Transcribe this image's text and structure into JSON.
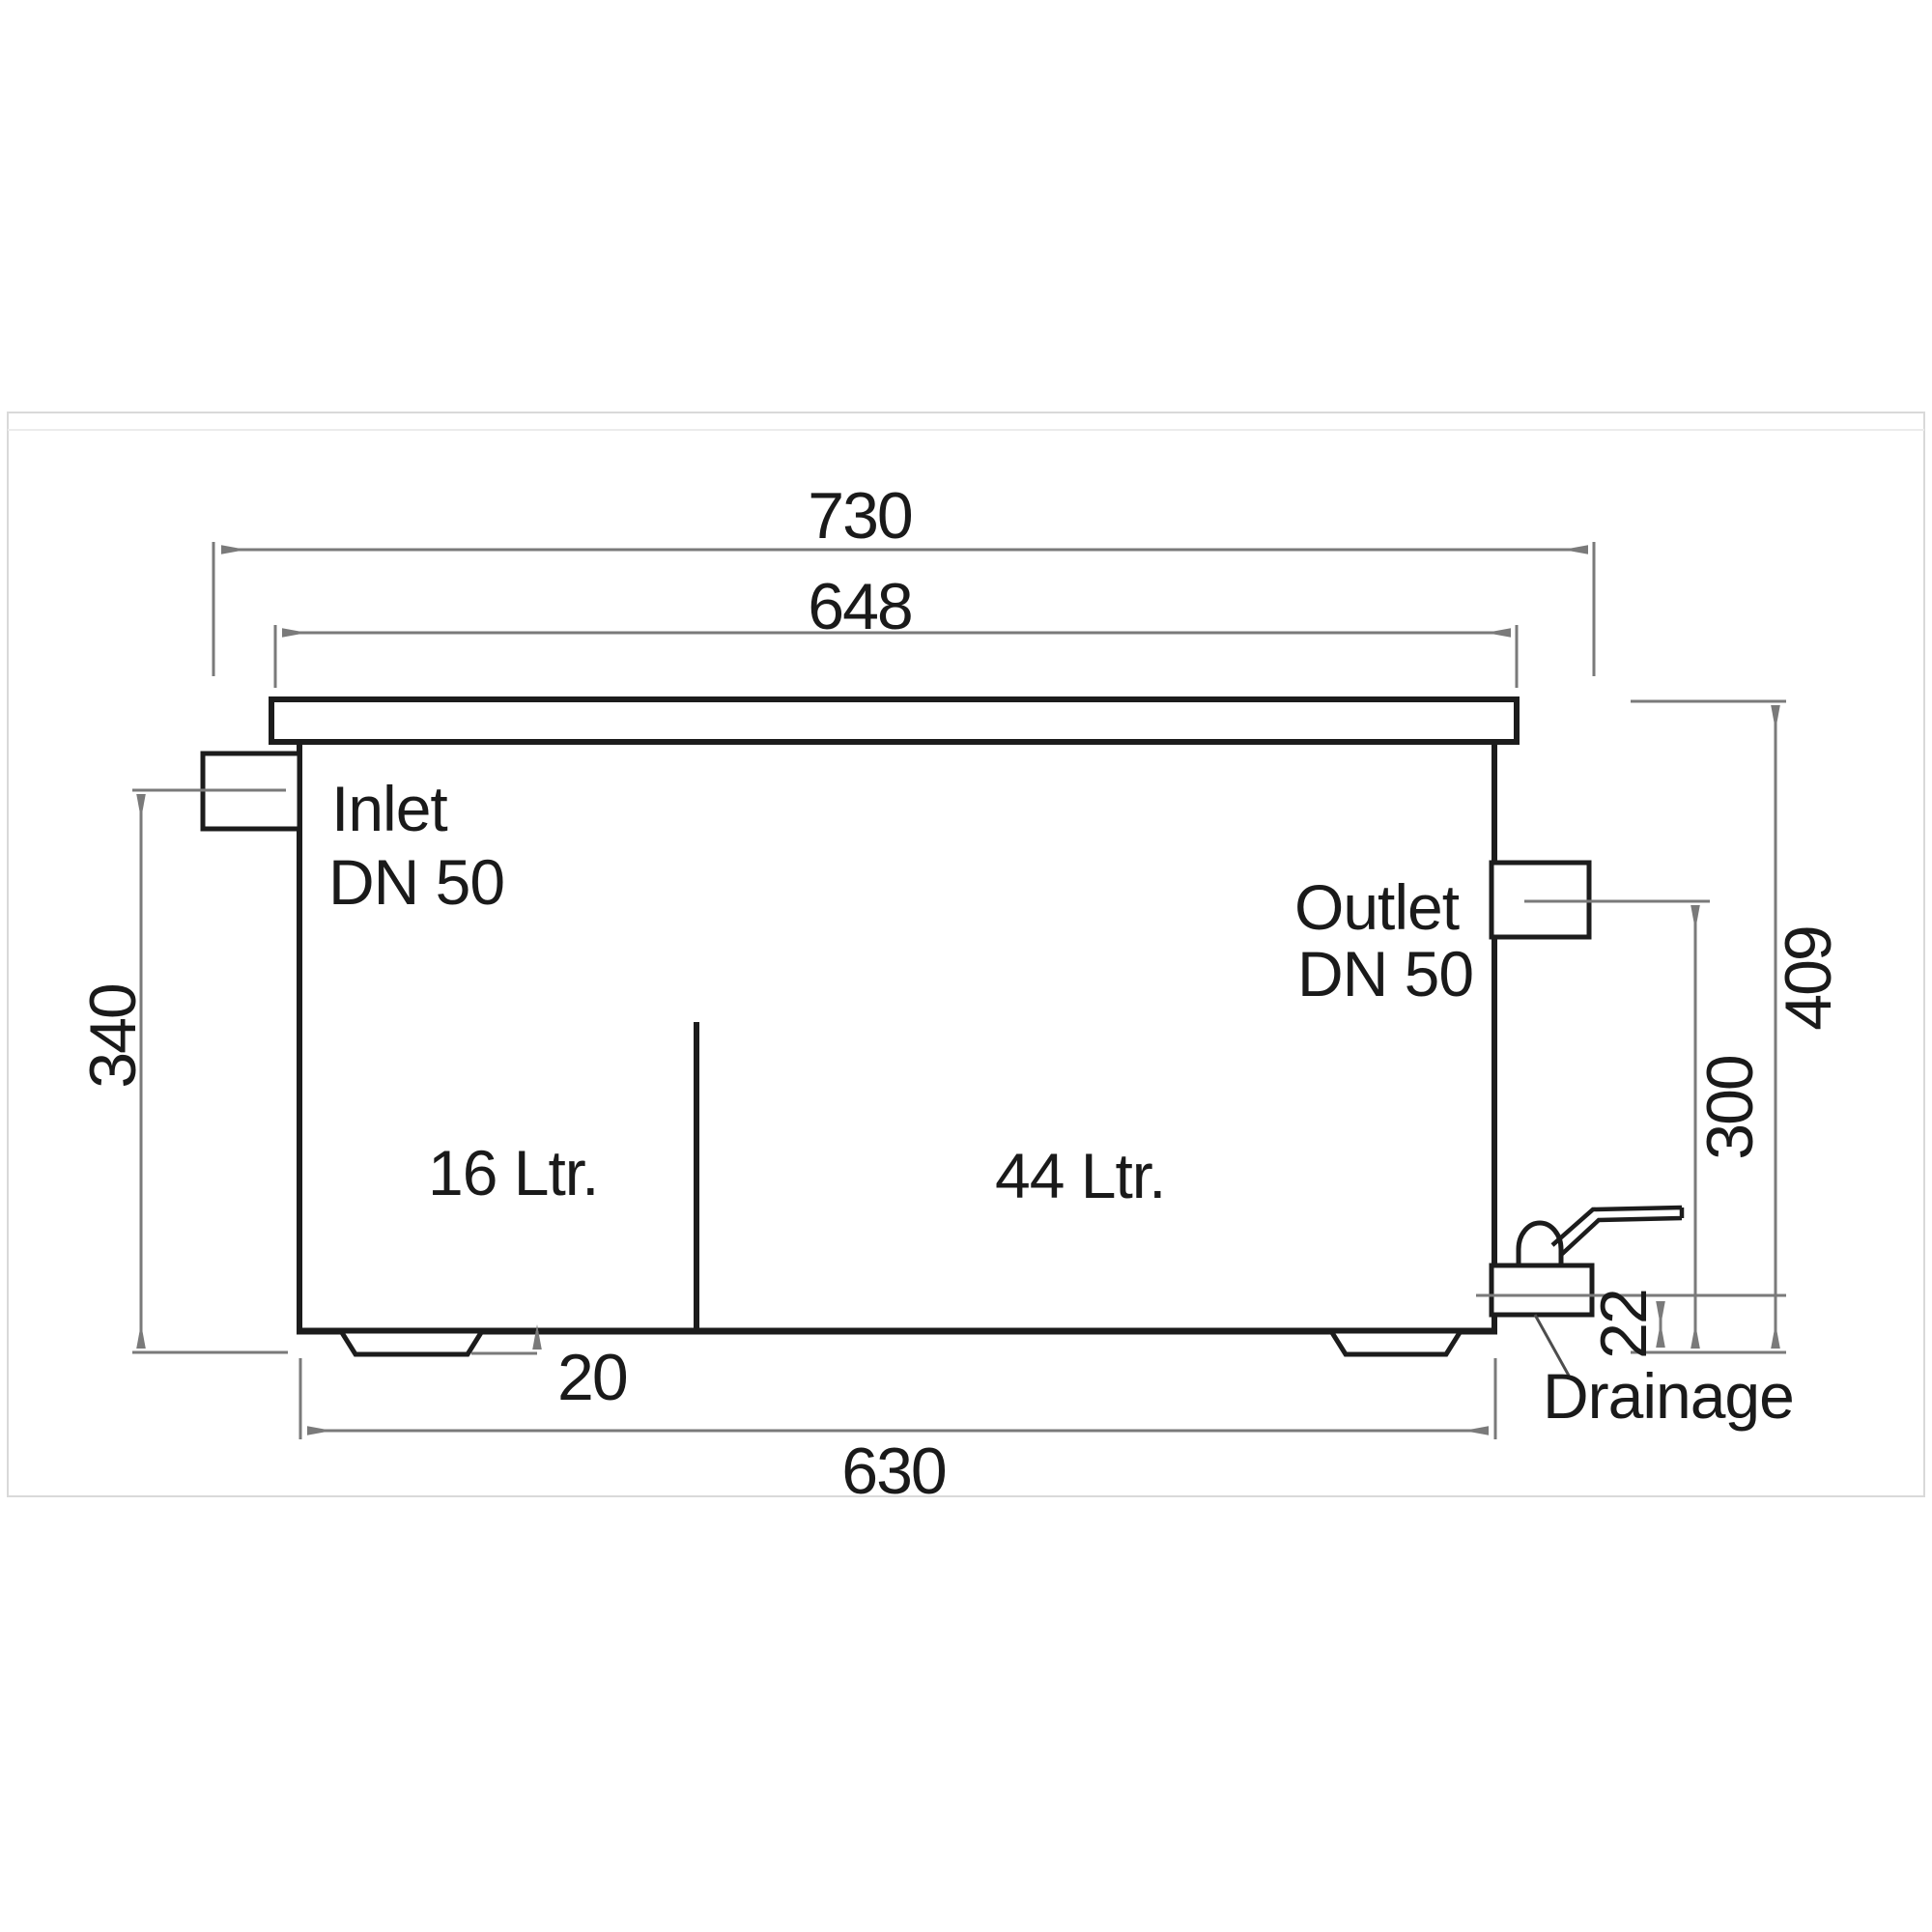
{
  "drawing": {
    "title_hint": "grease-separator side elevation technical drawing",
    "labels": {
      "inlet_line1": "Inlet",
      "inlet_line2": "DN 50",
      "outlet_line1": "Outlet",
      "outlet_line2": "DN 50",
      "compartment_left_volume": "16 Ltr.",
      "compartment_right_volume": "44 Ltr.",
      "drainage": "Drainage"
    },
    "dimensions": {
      "top_outer_width": "730",
      "lid_width": "648",
      "inlet_center_height": "340",
      "overall_height": "409",
      "outlet_center_height": "300",
      "drain_center_height": "22",
      "foot_height": "20",
      "base_width": "630"
    },
    "colors": {
      "outline": "#1c1c1c",
      "dimension": "#7a7a7a",
      "leader": "#4d4d4d",
      "text": "#1a1a1a",
      "frame": "#d9d9d9",
      "frame_inner": "#ececec"
    }
  }
}
